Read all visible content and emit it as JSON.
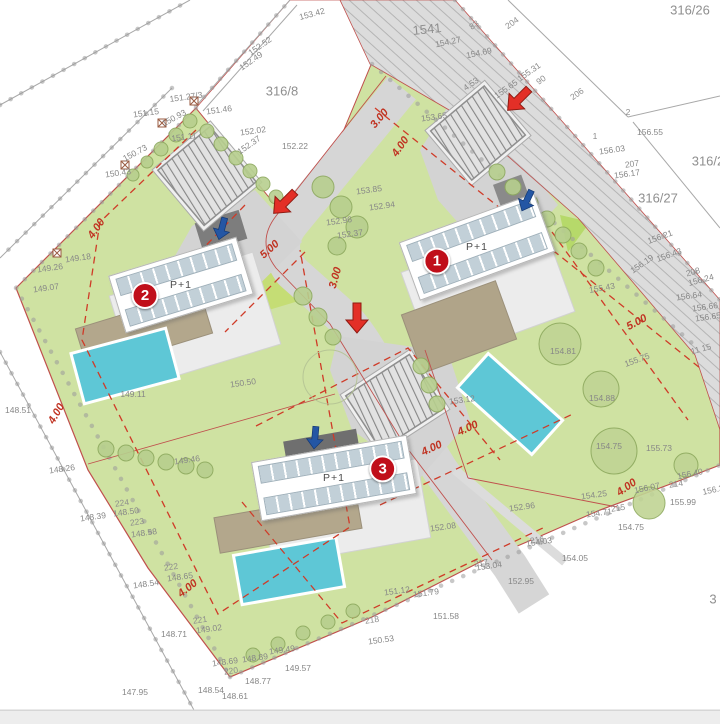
{
  "plan": {
    "houses": [
      {
        "number": "1",
        "floors": "P+1"
      },
      {
        "number": "2",
        "floors": "P+1"
      },
      {
        "number": "3",
        "floors": "P+1"
      }
    ],
    "parcels": [
      {
        "t": "1541",
        "x": 427,
        "y": 29,
        "r": -6
      },
      {
        "t": "316/26",
        "x": 690,
        "y": 10,
        "r": 0
      },
      {
        "t": "316/8",
        "x": 282,
        "y": 91,
        "r": 0
      },
      {
        "t": "316/2",
        "x": 708,
        "y": 161,
        "r": 0
      },
      {
        "t": "316/27",
        "x": 658,
        "y": 198,
        "r": 0
      },
      {
        "t": "3",
        "x": 713,
        "y": 599,
        "r": 0
      }
    ],
    "elevations": [
      {
        "t": "153.42",
        "x": 312,
        "y": 14,
        "r": -15
      },
      {
        "t": "152.52",
        "x": 260,
        "y": 46,
        "r": -35
      },
      {
        "t": "152.49",
        "x": 251,
        "y": 61,
        "r": -35
      },
      {
        "t": "154.27",
        "x": 448,
        "y": 42,
        "r": -12
      },
      {
        "t": "154.69",
        "x": 479,
        "y": 53,
        "r": -12
      },
      {
        "t": "155.31",
        "x": 529,
        "y": 72,
        "r": -35
      },
      {
        "t": "151.27/3",
        "x": 186,
        "y": 97,
        "r": -8
      },
      {
        "t": "151.46",
        "x": 219,
        "y": 110,
        "r": -8
      },
      {
        "t": "151.15",
        "x": 146,
        "y": 113,
        "r": -8
      },
      {
        "t": "150.93",
        "x": 174,
        "y": 118,
        "r": -28
      },
      {
        "t": "151.11",
        "x": 184,
        "y": 137,
        "r": -8
      },
      {
        "t": "152.02",
        "x": 253,
        "y": 131,
        "r": -8
      },
      {
        "t": "152.37",
        "x": 249,
        "y": 145,
        "r": -35
      },
      {
        "t": "152.22",
        "x": 295,
        "y": 146,
        "r": 0
      },
      {
        "t": "150.73",
        "x": 135,
        "y": 153,
        "r": -28
      },
      {
        "t": "150.43",
        "x": 118,
        "y": 173,
        "r": -8
      },
      {
        "t": "4.53",
        "x": 471,
        "y": 84,
        "r": -35
      },
      {
        "t": "155.65",
        "x": 506,
        "y": 89,
        "r": -35
      },
      {
        "t": "153.65",
        "x": 434,
        "y": 117,
        "r": -8
      },
      {
        "t": "156.55",
        "x": 650,
        "y": 132,
        "r": 0
      },
      {
        "t": "156.03",
        "x": 612,
        "y": 150,
        "r": -8
      },
      {
        "t": "156.17",
        "x": 627,
        "y": 174,
        "r": -8
      },
      {
        "t": "156.21",
        "x": 660,
        "y": 237,
        "r": -20
      },
      {
        "t": "156.43",
        "x": 669,
        "y": 255,
        "r": -20
      },
      {
        "t": "156.19",
        "x": 642,
        "y": 264,
        "r": -35
      },
      {
        "t": "156.24",
        "x": 701,
        "y": 280,
        "r": -15
      },
      {
        "t": "156.64",
        "x": 689,
        "y": 296,
        "r": -8
      },
      {
        "t": "156.66",
        "x": 705,
        "y": 307,
        "r": -8
      },
      {
        "t": "156.65",
        "x": 708,
        "y": 317,
        "r": -8
      },
      {
        "t": "155.43",
        "x": 602,
        "y": 288,
        "r": -10
      },
      {
        "t": "155.75",
        "x": 637,
        "y": 360,
        "r": -20
      },
      {
        "t": "154.81",
        "x": 563,
        "y": 351,
        "r": 0
      },
      {
        "t": "154.88",
        "x": 602,
        "y": 398,
        "r": 0
      },
      {
        "t": "154.75",
        "x": 609,
        "y": 446,
        "r": 0
      },
      {
        "t": "155.73",
        "x": 659,
        "y": 448,
        "r": 0
      },
      {
        "t": "154.25",
        "x": 594,
        "y": 495,
        "r": -8
      },
      {
        "t": "156.07",
        "x": 647,
        "y": 488,
        "r": -12
      },
      {
        "t": "156.40",
        "x": 690,
        "y": 474,
        "r": -12
      },
      {
        "t": "156.3",
        "x": 713,
        "y": 490,
        "r": -12
      },
      {
        "t": "155.99",
        "x": 683,
        "y": 502,
        "r": 0
      },
      {
        "t": "154.71",
        "x": 599,
        "y": 513,
        "r": -8
      },
      {
        "t": "154.75",
        "x": 631,
        "y": 527,
        "r": 0
      },
      {
        "t": "154.05",
        "x": 575,
        "y": 558,
        "r": 0
      },
      {
        "t": "154.03",
        "x": 539,
        "y": 542,
        "r": -8
      },
      {
        "t": "152.96",
        "x": 522,
        "y": 507,
        "r": -8
      },
      {
        "t": "152.95",
        "x": 521,
        "y": 581,
        "r": 0
      },
      {
        "t": "153.04",
        "x": 489,
        "y": 566,
        "r": -8
      },
      {
        "t": "152.08",
        "x": 443,
        "y": 527,
        "r": -8
      },
      {
        "t": "153.12",
        "x": 462,
        "y": 400,
        "r": -8
      },
      {
        "t": "152.94",
        "x": 382,
        "y": 206,
        "r": -8
      },
      {
        "t": "152.96",
        "x": 339,
        "y": 221,
        "r": -8
      },
      {
        "t": "152.37",
        "x": 350,
        "y": 234,
        "r": -8
      },
      {
        "t": "153.85",
        "x": 369,
        "y": 190,
        "r": -8
      },
      {
        "t": "149.18",
        "x": 78,
        "y": 258,
        "r": -8
      },
      {
        "t": "149.26",
        "x": 50,
        "y": 268,
        "r": -8
      },
      {
        "t": "149.07",
        "x": 46,
        "y": 288,
        "r": -8
      },
      {
        "t": "148.51",
        "x": 18,
        "y": 410,
        "r": 0
      },
      {
        "t": "148.26",
        "x": 62,
        "y": 469,
        "r": -8
      },
      {
        "t": "148.39",
        "x": 93,
        "y": 517,
        "r": -8
      },
      {
        "t": "148.50",
        "x": 126,
        "y": 512,
        "r": -8
      },
      {
        "t": "148.58",
        "x": 144,
        "y": 533,
        "r": -8
      },
      {
        "t": "148.65",
        "x": 180,
        "y": 577,
        "r": -8
      },
      {
        "t": "148.54",
        "x": 146,
        "y": 584,
        "r": -8
      },
      {
        "t": "148.71",
        "x": 174,
        "y": 634,
        "r": 0
      },
      {
        "t": "149.02",
        "x": 209,
        "y": 629,
        "r": -8
      },
      {
        "t": "148.69",
        "x": 225,
        "y": 662,
        "r": -8
      },
      {
        "t": "148.89",
        "x": 255,
        "y": 658,
        "r": -8
      },
      {
        "t": "149.49",
        "x": 282,
        "y": 650,
        "r": -8
      },
      {
        "t": "149.57",
        "x": 298,
        "y": 668,
        "r": 0
      },
      {
        "t": "148.77",
        "x": 258,
        "y": 681,
        "r": 0
      },
      {
        "t": "148.61",
        "x": 235,
        "y": 696,
        "r": 0
      },
      {
        "t": "148.54",
        "x": 211,
        "y": 690,
        "r": 0
      },
      {
        "t": "147.95",
        "x": 135,
        "y": 692,
        "r": 0
      },
      {
        "t": "149.46",
        "x": 187,
        "y": 460,
        "r": -8
      },
      {
        "t": "150.50",
        "x": 243,
        "y": 383,
        "r": -8
      },
      {
        "t": "149.11",
        "x": 133,
        "y": 394,
        "r": 0
      },
      {
        "t": "151.12",
        "x": 397,
        "y": 591,
        "r": -8
      },
      {
        "t": "151.79",
        "x": 426,
        "y": 593,
        "r": -8
      },
      {
        "t": "151.58",
        "x": 446,
        "y": 616,
        "r": 0
      },
      {
        "t": "150.53",
        "x": 381,
        "y": 640,
        "r": -8
      }
    ],
    "points": [
      {
        "t": "2",
        "x": 628,
        "y": 112,
        "r": 0
      },
      {
        "t": "1",
        "x": 595,
        "y": 136,
        "r": 0
      },
      {
        "t": "207",
        "x": 632,
        "y": 164,
        "r": -8
      },
      {
        "t": "208",
        "x": 693,
        "y": 272,
        "r": -15
      },
      {
        "t": "83",
        "x": 474,
        "y": 25,
        "r": -35
      },
      {
        "t": "204",
        "x": 512,
        "y": 23,
        "r": -35
      },
      {
        "t": "90",
        "x": 541,
        "y": 80,
        "r": -35
      },
      {
        "t": "206",
        "x": 577,
        "y": 94,
        "r": -35
      },
      {
        "t": "11  15",
        "x": 701,
        "y": 349,
        "r": -15
      },
      {
        "t": "214",
        "x": 676,
        "y": 484,
        "r": -8
      },
      {
        "t": "215",
        "x": 618,
        "y": 508,
        "r": -8
      },
      {
        "t": "216",
        "x": 537,
        "y": 540,
        "r": -8
      },
      {
        "t": "217",
        "x": 481,
        "y": 563,
        "r": -8
      },
      {
        "t": "218",
        "x": 372,
        "y": 620,
        "r": -8
      },
      {
        "t": "220",
        "x": 231,
        "y": 671,
        "r": -8
      },
      {
        "t": "221",
        "x": 200,
        "y": 620,
        "r": -8
      },
      {
        "t": "222",
        "x": 171,
        "y": 567,
        "r": -8
      },
      {
        "t": "223",
        "x": 137,
        "y": 522,
        "r": -8
      },
      {
        "t": "224",
        "x": 122,
        "y": 503,
        "r": -8
      }
    ],
    "dimensions": [
      {
        "t": "3.00",
        "x": 380,
        "y": 119,
        "r": -50
      },
      {
        "t": "4.00",
        "x": 401,
        "y": 147,
        "r": -55
      },
      {
        "t": "5.00",
        "x": 270,
        "y": 250,
        "r": -42
      },
      {
        "t": "3.00",
        "x": 336,
        "y": 278,
        "r": -74
      },
      {
        "t": "4.00",
        "x": 97,
        "y": 229,
        "r": -55
      },
      {
        "t": "4.00",
        "x": 57,
        "y": 414,
        "r": -60
      },
      {
        "t": "4.00",
        "x": 188,
        "y": 589,
        "r": -38
      },
      {
        "t": "4.00",
        "x": 432,
        "y": 449,
        "r": -25
      },
      {
        "t": "4.00",
        "x": 468,
        "y": 429,
        "r": -25
      },
      {
        "t": "5.00",
        "x": 637,
        "y": 323,
        "r": -28
      },
      {
        "t": "4.00",
        "x": 627,
        "y": 488,
        "r": -35
      }
    ],
    "colors": {
      "terrain_green": "#cfe2a2",
      "road_gray": "#dcdcdc",
      "pool_cyan": "#5ec7d6",
      "roof_tan": "#b3a78c",
      "setback_red_dash": "#cf3b28",
      "boundary_red": "#c0504d",
      "badge_red": "#c00f1a",
      "arrow_red": "#e32f27",
      "arrow_blue": "#2456a4"
    }
  }
}
